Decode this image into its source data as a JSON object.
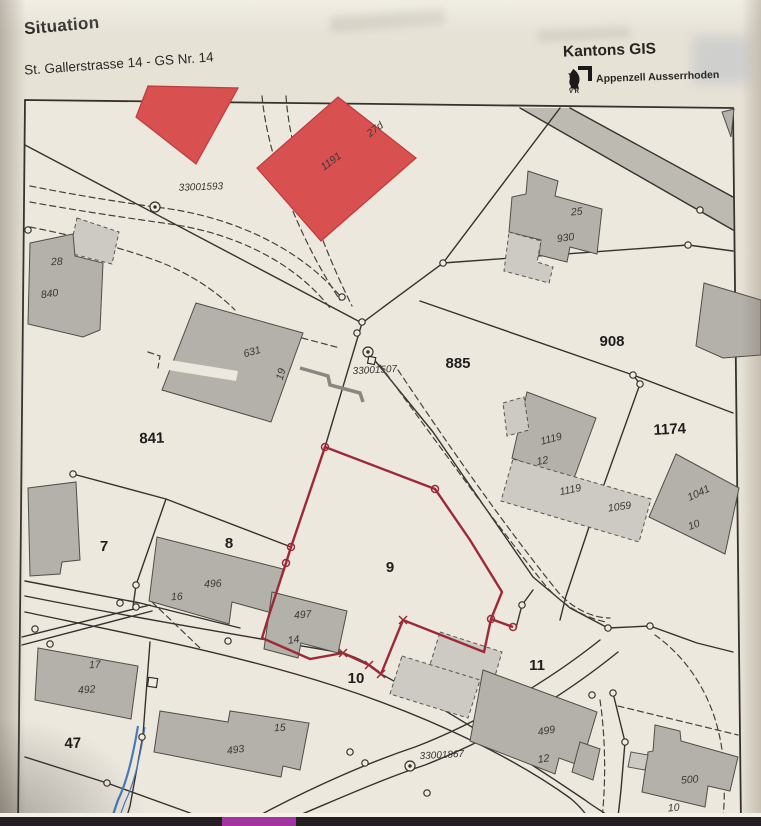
{
  "header": {
    "title": "Situation",
    "subtitle": "St. Gallerstrasse 14 - GS Nr. 14",
    "org": "Kantons GIS",
    "org_sub": "Appenzell Ausserrhoden"
  },
  "map": {
    "survey_labels": {
      "s1593": "33001593",
      "s1507": "33001507",
      "s1867": "33001867"
    },
    "parcel_labels": {
      "p841": "841",
      "p885": "885",
      "p908": "908",
      "p1174": "1174",
      "p7": "7",
      "p8": "8",
      "p9": "9",
      "p10": "10",
      "p11": "11",
      "p47": "47"
    },
    "building_labels": {
      "b28": "28",
      "b840": "840",
      "b631": "631",
      "b19": "19",
      "b1191": "1191",
      "b27d": "27d",
      "b25": "25",
      "b930": "930",
      "b1119a": "1119",
      "b12a": "12",
      "b1119b": "1119",
      "b1059": "1059",
      "b1041": "1041",
      "b10a": "10",
      "b496": "496",
      "b16": "16",
      "b497": "497",
      "b14": "14",
      "b17": "17",
      "b492": "492",
      "b15": "15",
      "b493": "493",
      "b499": "499",
      "b12b": "12",
      "b500": "500",
      "b10b": "10"
    }
  },
  "colors": {
    "highlight_red": "#9e2936",
    "building_red": "#d85050",
    "building_gray": "#b4b1ab",
    "building_gray_light": "#cdcac4",
    "paper": "#e7e2d6",
    "ink": "#35322e",
    "stream_blue": "#4a7ab5",
    "photo_edge_dark": "#251e23",
    "photo_edge_magenta": "#a233a0"
  }
}
